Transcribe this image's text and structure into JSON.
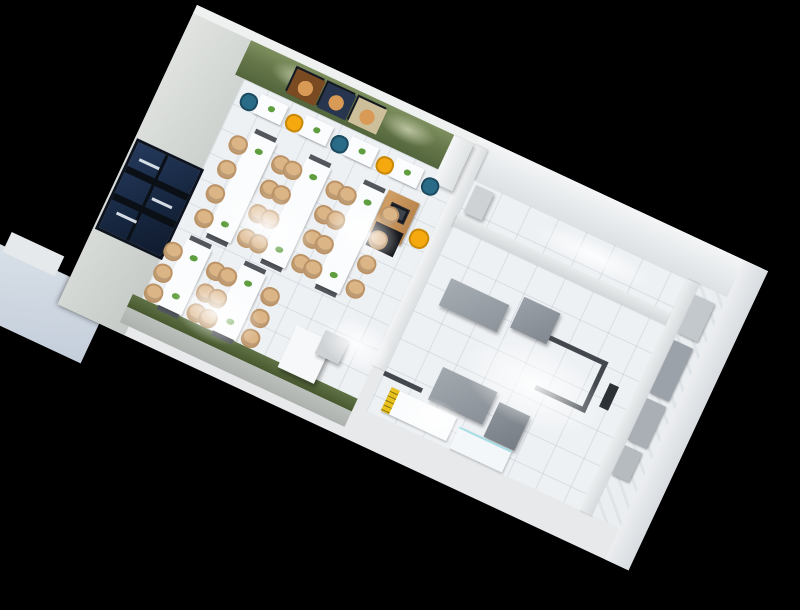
{
  "scene": {
    "description": "3D isometric cutaway render of a small fast-food restaurant floor plan, viewed from above at an angle on a black background",
    "view": "top-down axonometric, building rotated about 25 degrees",
    "background_color": "#000000"
  },
  "colors": {
    "background": "#000000",
    "outer_wall": "#e7e9eb",
    "left_wall": "#d2d6d2",
    "green_wall": "#66784a",
    "floor_tile": "#eef1f4",
    "door_navy": "#16263f",
    "chair_teal": "#2a6b87",
    "chair_yellow": "#f5a90f",
    "chair_wood": "#dcb587",
    "table_white": "#fbfcfd",
    "counter_wood": "#c5945a",
    "counter_base": "#17191e",
    "equipment_gray": "#98a0a7",
    "partition_cap": "#43484e",
    "canopy": "#c9d3de",
    "stripe_yellow": "#e8c11c",
    "poster_frame": "#141821",
    "plant_green": "#5f9e3f"
  },
  "rooms": [
    {
      "id": "dining-hall",
      "wall_accent": "olive-green",
      "floor": "white tile",
      "features": [
        "navy double entry door in left wall",
        "three food posters on green wall",
        "four two-seat wall tables with teal and yellow chairs",
        "five long canteen tables with wooden chairs",
        "cashier counter with POS monitor and yellow chair",
        "white service box near kitchen doorway"
      ]
    },
    {
      "id": "kitchen",
      "floor": "white tile",
      "features": [
        "gray stainless prep counters",
        "low dark-capped partition walls",
        "pass-through slot",
        "serving counter with yellow striped edge",
        "white glass panel"
      ]
    },
    {
      "id": "back-corridor",
      "features": [
        "empty white corridor along the top wall",
        "small gray cabinet"
      ]
    },
    {
      "id": "storage-room",
      "features": [
        "gray storage cabinets and shelving along inner wall",
        "diagonal plank floor"
      ]
    },
    {
      "id": "exterior",
      "features": [
        "light blue-gray entrance canopy outside the bottom-left wall"
      ]
    }
  ],
  "inventory": {
    "posters": 3,
    "double_doors": 1,
    "two_seat_wall_tables": 4,
    "long_tables": 5,
    "wood_chairs": 36,
    "teal_chairs": 4,
    "yellow_chairs": 5,
    "cashier_counters": 1,
    "pos_monitors": 1,
    "kitchen_equipment_units": 4,
    "storage_cabinets": 4,
    "serving_counters": 1,
    "ceiling_light_glows": 7
  }
}
